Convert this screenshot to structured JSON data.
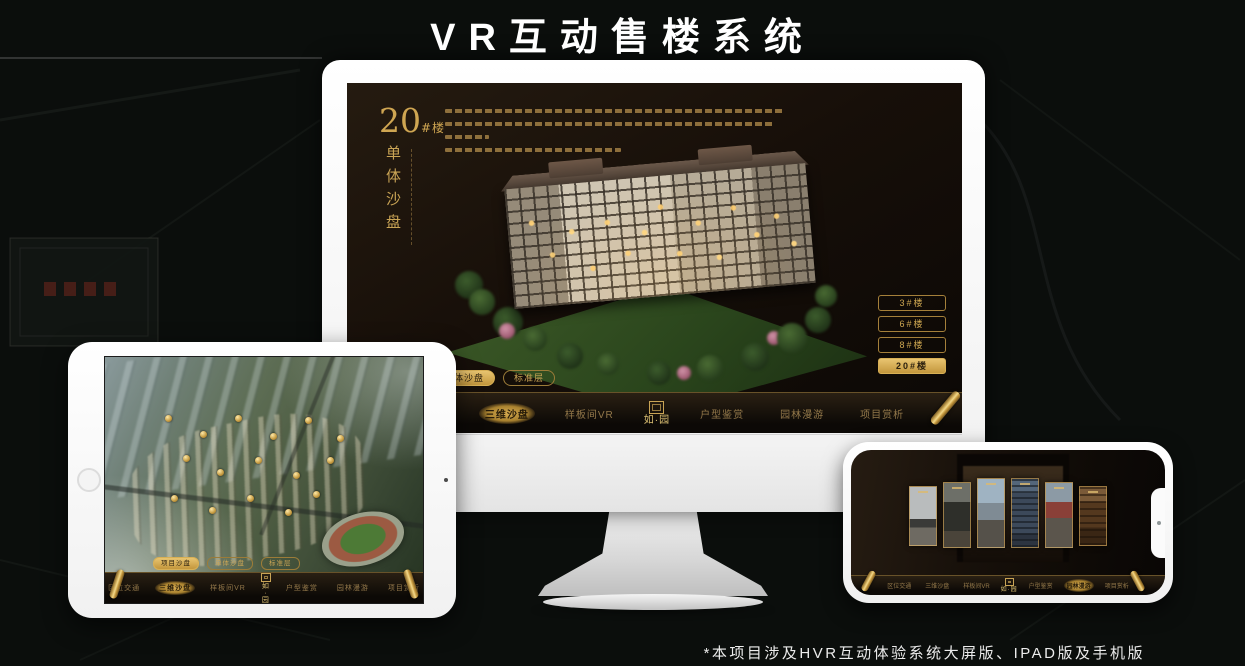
{
  "page": {
    "title": "VR互动售楼系统",
    "footnote": "*本项目涉及HVR互动体验系统大屏版、IPAD版及手机版"
  },
  "theme": {
    "gold": "#c9a455",
    "gold_bright": "#e8c470",
    "screen_dark": "#170f09",
    "device_frame": "#f7f7f7"
  },
  "nav": {
    "logo": "如·园",
    "items": [
      "区位交通",
      "三维沙盘",
      "样板间VR",
      "户型鉴赏",
      "园林漫游",
      "项目赏析"
    ],
    "active_item": "三维沙盘"
  },
  "sub_tabs": [
    "项目沙盘",
    "单体沙盘",
    "标准层"
  ],
  "monitor": {
    "building_number": "20",
    "building_unit": "#楼",
    "section_title": "单体沙盘",
    "active_sub_tab": "单体沙盘",
    "floors": [
      "3#楼",
      "6#楼",
      "8#楼",
      "20#楼"
    ],
    "active_floor": "20#楼"
  },
  "tablet": {
    "active_sub_tab": "项目沙盘",
    "active_nav_item": "三维沙盘"
  },
  "phone": {
    "active_nav_item": "园林漫游"
  }
}
